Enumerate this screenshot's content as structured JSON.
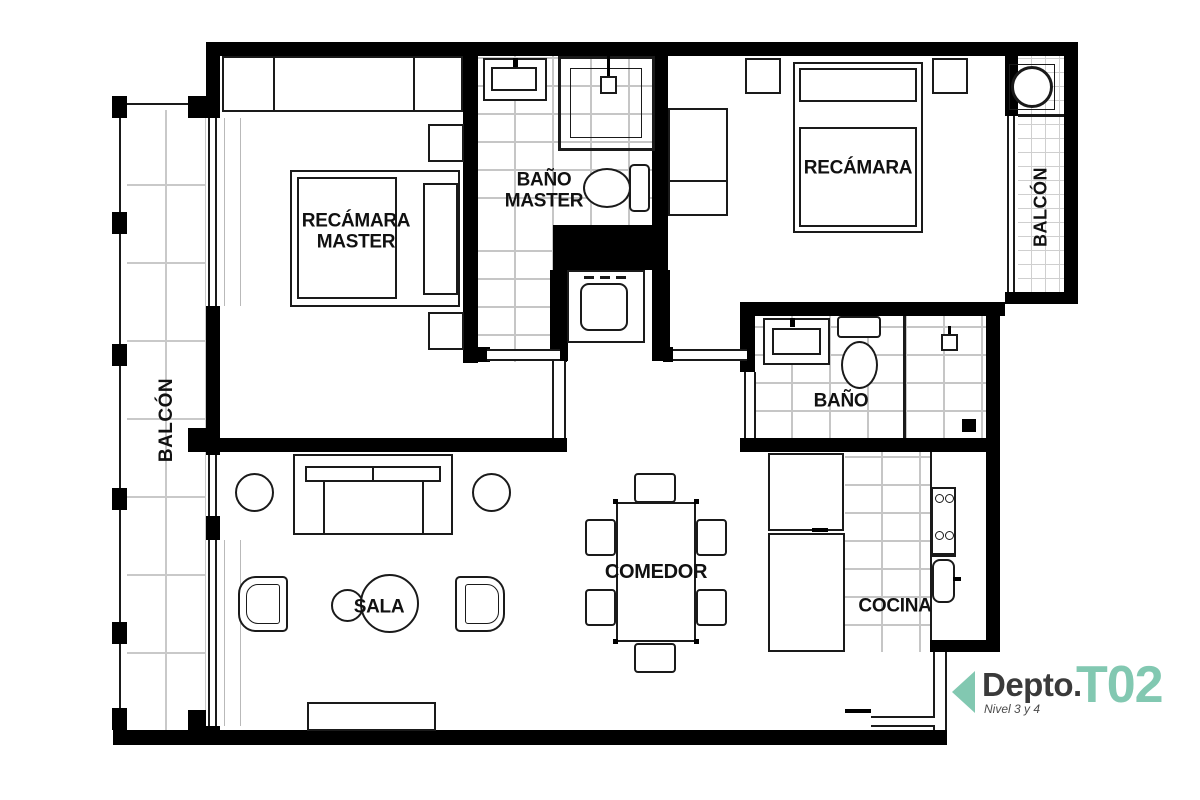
{
  "badge": {
    "prefix": "Depto.",
    "unit": "T02",
    "subtitle": "Nivel 3 y 4"
  },
  "rooms": {
    "recamara_master": "RECÁMARA\nMASTER",
    "bano_master": "BAÑO\nMASTER",
    "recamara": "RECÁMARA",
    "balcon_left": "BALCÓN",
    "balcon_right": "BALCÓN",
    "bano": "BAÑO",
    "sala": "SALA",
    "comedor": "COMEDOR",
    "cocina": "COCINA"
  },
  "colors": {
    "accent": "#82C8B1",
    "wall": "#000000",
    "furniture_line": "#1a1a1a",
    "tile_line": "#c9c9c9"
  }
}
